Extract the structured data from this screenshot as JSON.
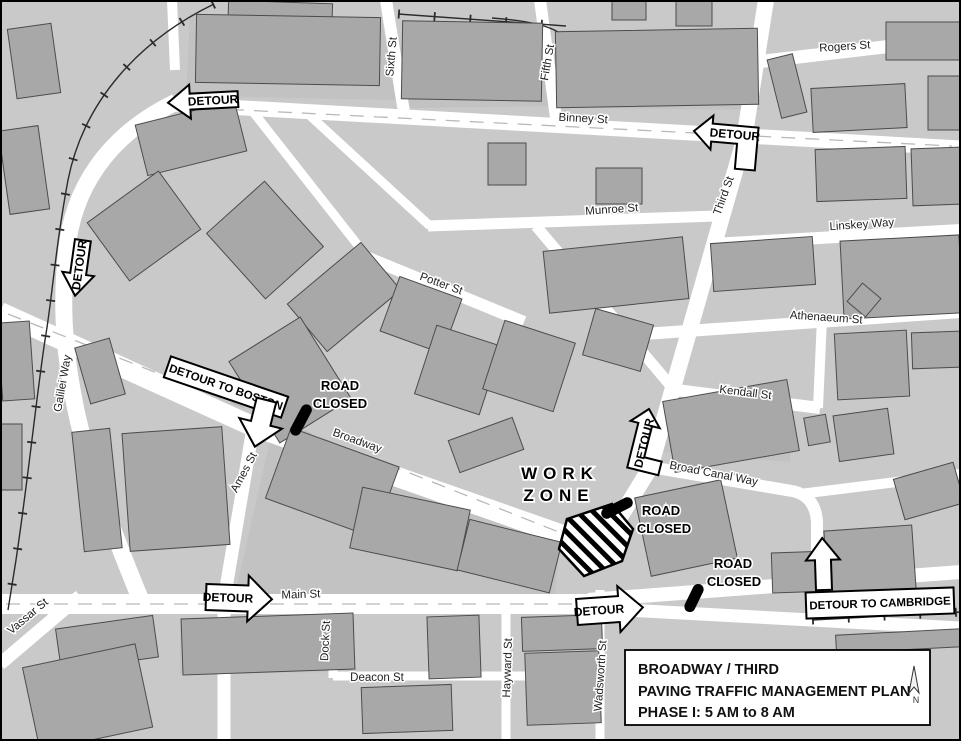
{
  "streets": {
    "rogers": "Rogers St",
    "binney": "Binney St",
    "sixth": "Sixth St",
    "fifth": "Fifth St",
    "third": "Third St",
    "munroe": "Munroe St",
    "linskey": "Linskey Way",
    "potter": "Potter St",
    "athenaeum": "Athenaeum St",
    "kendall": "Kendall St",
    "broad_canal": "Broad Canal Way",
    "galilei": "Galilei Way",
    "broadway": "Broadway",
    "ames": "Ames St",
    "vassar": "Vassar St",
    "main": "Main St",
    "dock": "Dock St",
    "deacon": "Deacon St",
    "hayward": "Hayward St",
    "wadsworth": "Wadsworth St"
  },
  "annotations": {
    "detour": "DETOUR",
    "detour_to_boston": "DETOUR TO BOSTON",
    "detour_to_cambridge": "DETOUR TO CAMBRIDGE",
    "road": "ROAD",
    "closed": "CLOSED",
    "work": "WORK",
    "zone": "ZONE",
    "north": "N"
  },
  "title_box": {
    "line1": "BROADWAY / THIRD",
    "line2": "PAVING TRAFFIC MANAGEMENT PLAN",
    "line3": "PHASE I: 5 AM to 8 AM"
  },
  "colors": {
    "background": "#c9c9c9",
    "block": "#c2c2c2",
    "building": "#a8a8a8",
    "building_outline": "#4c4c4c",
    "road": "#ffffff",
    "closure": "#000000",
    "rail": "#2b2b2b"
  }
}
